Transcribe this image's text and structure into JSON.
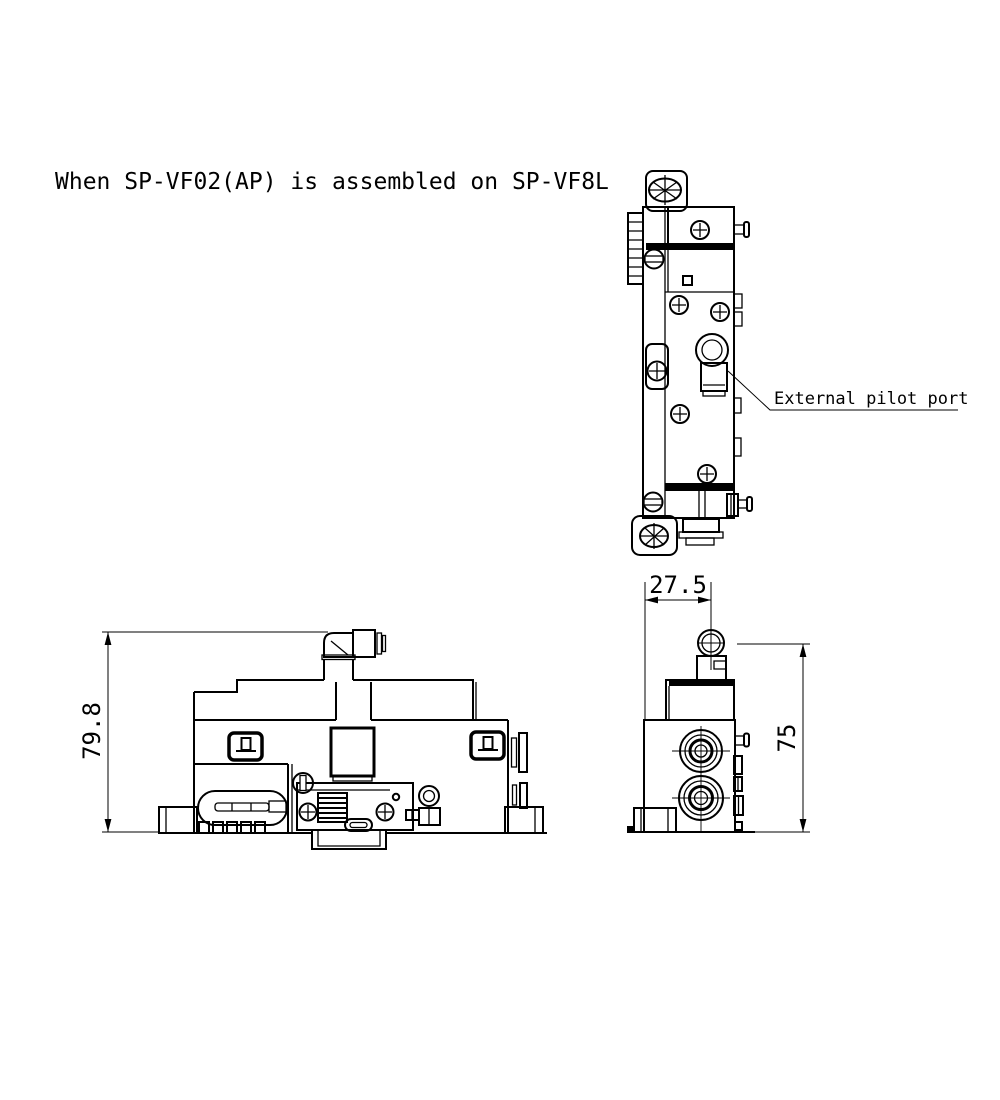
{
  "page": {
    "background": "#ffffff",
    "line_color": "#000000"
  },
  "drawing": {
    "title": "When SP-VF02(AP) is assembled on SP-VF8L",
    "callout": {
      "label": "External pilot port"
    },
    "dimensions": {
      "front_view_height_mm": "79.8",
      "side_view_width_mm": "27.5",
      "side_view_height_mm": "75"
    }
  }
}
